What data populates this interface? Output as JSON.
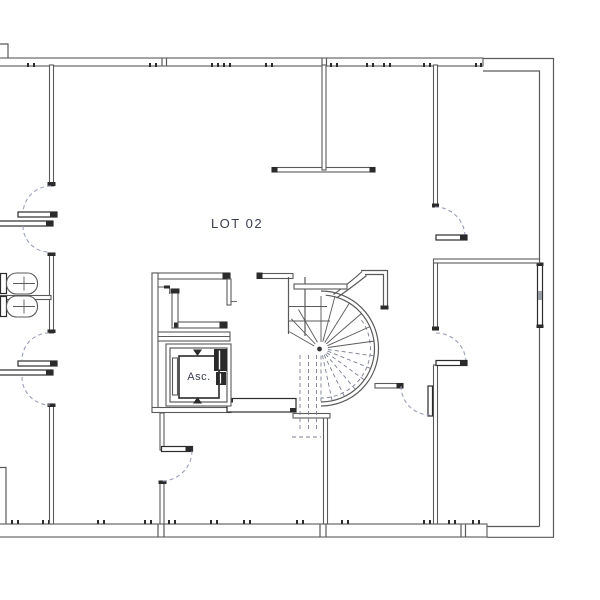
{
  "labels": {
    "lot": "LOT 02",
    "elevator": "Asc."
  },
  "colors": {
    "background": "#ffffff",
    "wall": "#5a5a5a",
    "wall_dark": "#2b2b2b",
    "swing": "#9aa0b8",
    "text": "#3b3f4e",
    "detail": "#9aa0a6"
  }
}
